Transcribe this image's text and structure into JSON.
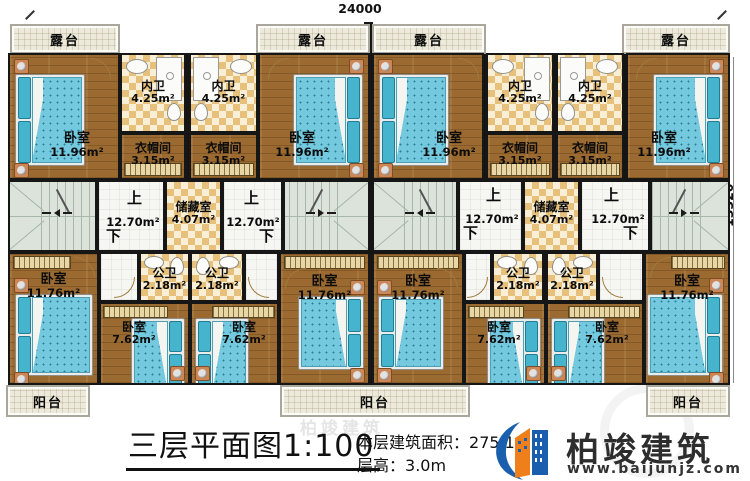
{
  "dimensions": {
    "width_mm": "24000",
    "height_mm": "13320"
  },
  "rooms": {
    "terrace": {
      "name": "露台"
    },
    "bedroom": {
      "name": "卧室",
      "area_top": "11.96m²",
      "area_bottom_large": "11.76m²",
      "area_bottom_small": "7.62m²"
    },
    "inner_bath": {
      "name": "内卫",
      "area": "4.25m²"
    },
    "cloakroom": {
      "name": "衣帽间",
      "area": "3.15m²"
    },
    "storage": {
      "name": "储藏室",
      "area": "4.07m²"
    },
    "hall": {
      "up": "上",
      "down": "下",
      "area": "12.70m²"
    },
    "public_bath": {
      "name": "公卫",
      "area": "2.18m²"
    },
    "balcony": {
      "name": "阳台"
    }
  },
  "title_block": {
    "title": "三层平面图1:100",
    "floor_area_label": "本层建筑面积：",
    "floor_area_value": "275.10",
    "floor_height_label": "层高：",
    "floor_height_value": "3.0m"
  },
  "logo": {
    "name": "柏竣建筑",
    "website": "www.baijunjz.com"
  }
}
